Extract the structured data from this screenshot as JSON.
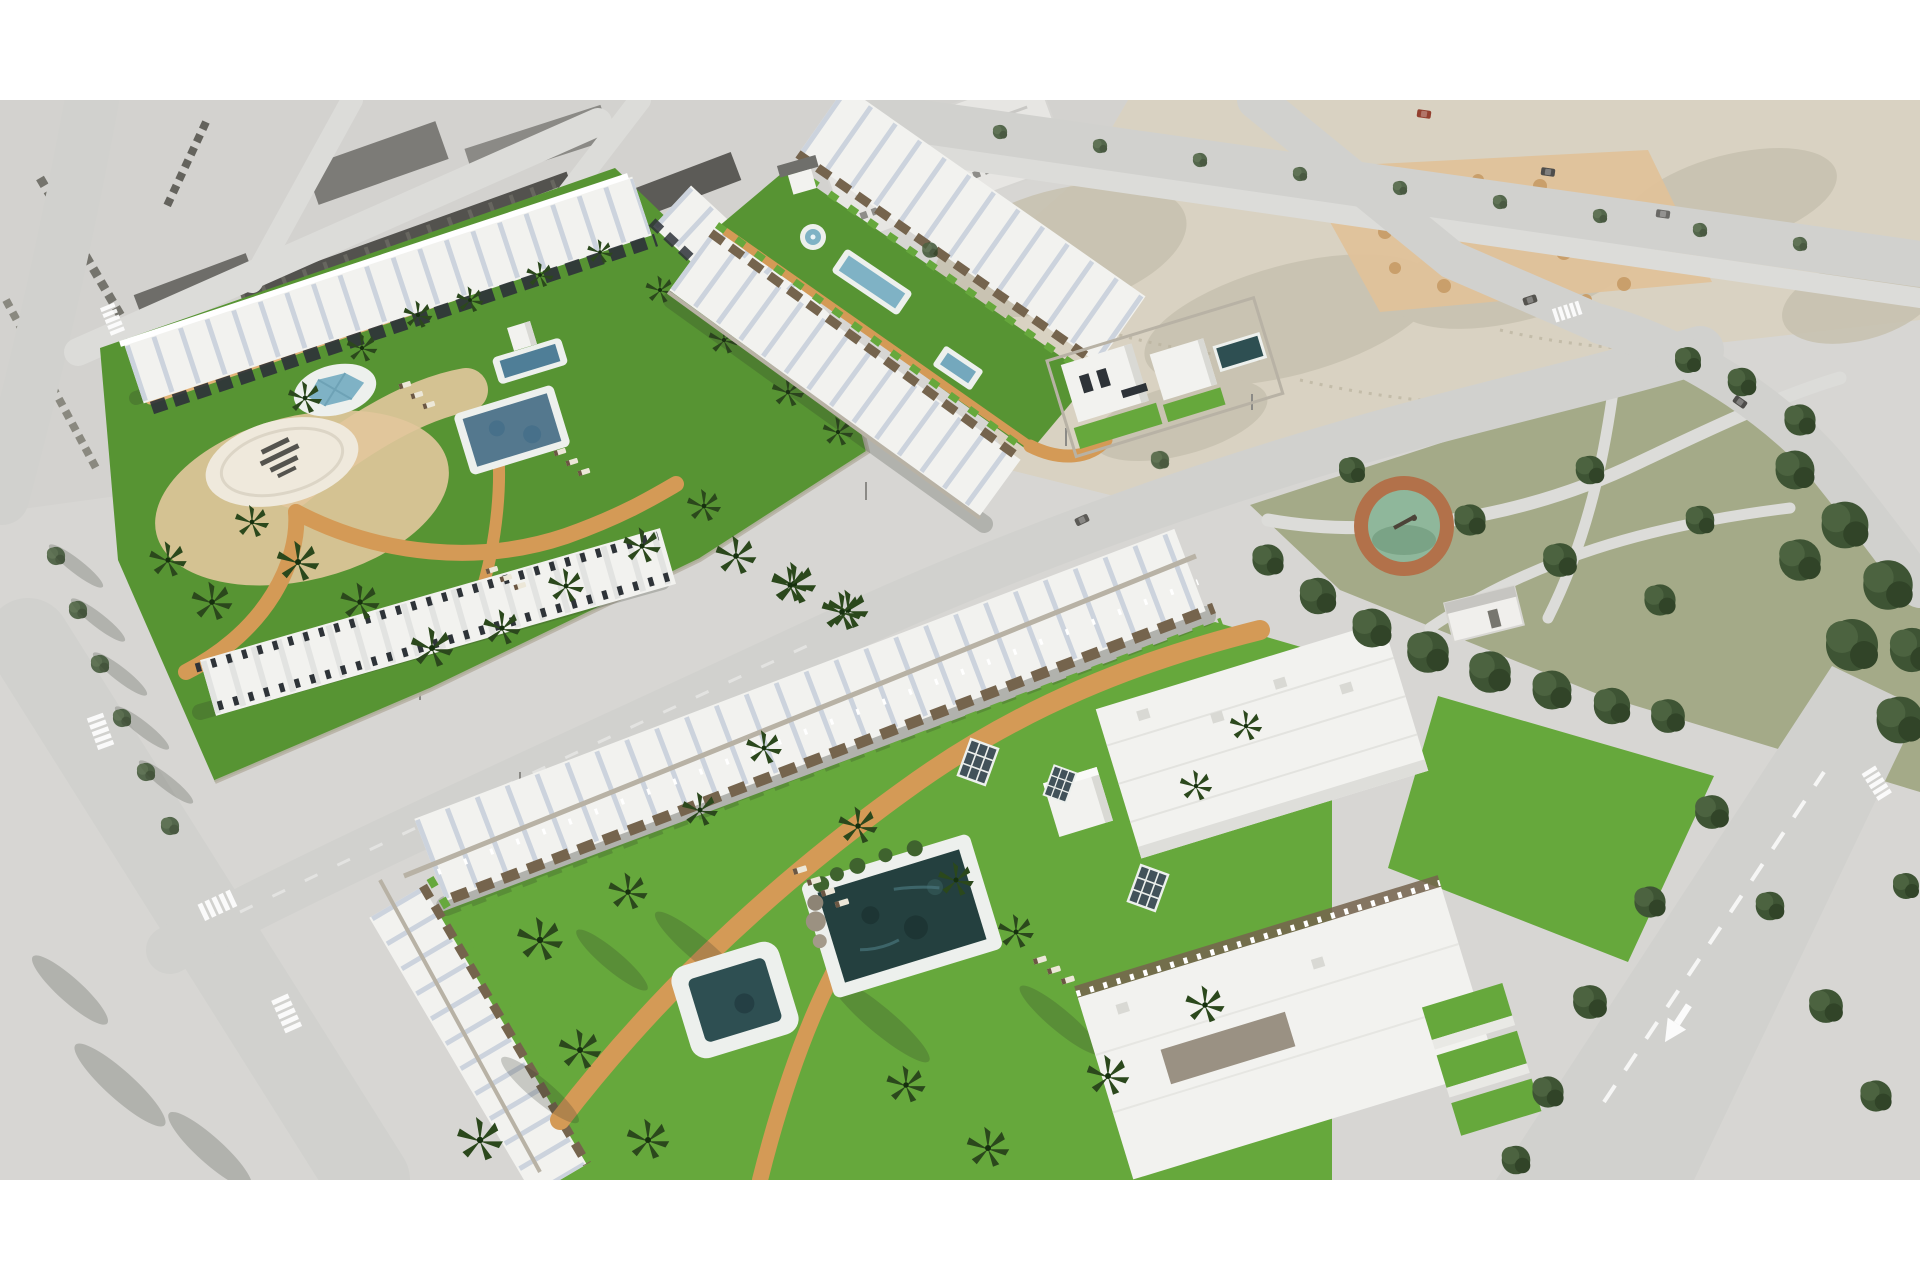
{
  "meta": {
    "kind": "aerial-architectural-render",
    "canvas": {
      "width": 1920,
      "height": 1280
    },
    "content_band": {
      "top": 100,
      "bottom": 1180
    }
  },
  "scene": {
    "labels": {
      "root": "Aerial 3D rendering of a residential development with white townhouses, green lawns, palm trees and swimming pools, surrounded by an existing town, vacant lots and a public park",
      "town": "Existing town blocks",
      "vacant": "Vacant land plots with sand piles",
      "park": "Public park with pine trees and circular playground",
      "roads": "Street network with crosswalks and lane markings",
      "north_complex": "North complex: courtyard garden, three pools and circular logo plaza",
      "east_complex": "East complex: linear garden with fountain, lap pool and detached villas",
      "south_complex": "South complex: large lawn, main pool, spa pool and apartment blocks",
      "trees": "Park and street trees",
      "letterbox_top": "White margin",
      "letterbox_bottom": "White margin"
    }
  },
  "palette": {
    "frame": "#ffffff",
    "ground": "#d7d6d3",
    "urban": "#d3d2cf",
    "dirt": "#d9d2c2",
    "scrub": "#c7c1af",
    "sandPile": "#e0c29a",
    "sandDot": "#c99f6b",
    "park": "#a4aa88",
    "road": "#d1d1ce",
    "roadLight": "#dcdcd9",
    "marking": "#ffffff",
    "grass": "#579433",
    "grassBright": "#66a83c",
    "path": "#d49a56",
    "pathLight": "#e2b377",
    "sand": "#e2c79c",
    "plaza": "#efe9dc",
    "building": "#f2f2ef",
    "buildingShade": "#d9d9d4",
    "roofStrip": "#ccd3dd",
    "facade": "#2e3338",
    "pergola": "#75644d",
    "wall": "#b8b2a5",
    "poolRim": "#edf0ed",
    "poolDark": "#24403f",
    "poolDeep": "#2e4f52",
    "poolSteel": "#54788e",
    "poolLight": "#7fb2c5",
    "treeDark": "#3e5434",
    "treeMid": "#4c6340",
    "treeDeep": "#314428",
    "palm": "#2b481c",
    "palmDeep": "#16300e",
    "glass": "#42525a",
    "lounger": "#ece7d8",
    "loungerPad": "#6b5743",
    "roofDark": "#53524e",
    "roofMid": "#6e6d69",
    "roofLight": "#8b8a86",
    "playRing": "#b2714a",
    "playIn": "#8fb79b",
    "playIn2": "#7aa386",
    "carRed": "#93402f",
    "carDark": "#4e4d4b",
    "logoMark": "#3b3b37",
    "shadow": "rgba(45,48,42,0.22)"
  }
}
